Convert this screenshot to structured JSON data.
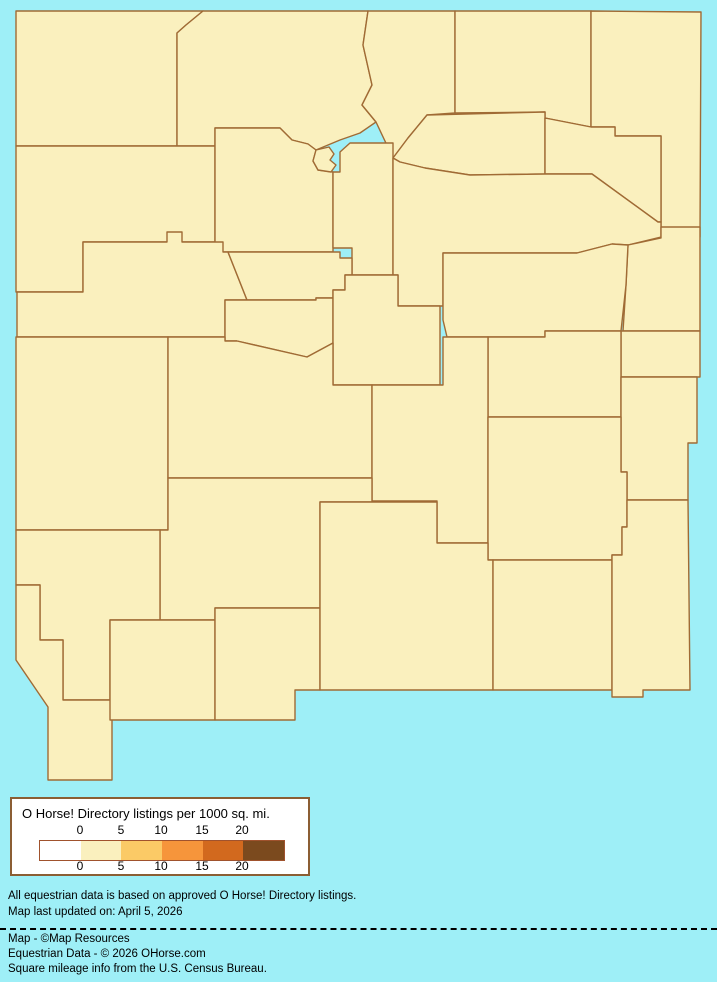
{
  "page": {
    "background_color": "#9EEFF7",
    "map_border_color": "#A06B35",
    "legend_border_color": "#8B5E34",
    "bar_border_color": "#A0522D"
  },
  "legend": {
    "title": "O Horse! Directory listings per 1000 sq. mi.",
    "ticks": [
      "0",
      "5",
      "10",
      "15",
      "20"
    ],
    "swatches": [
      {
        "bucket": "0",
        "color": "#FFFFFF"
      },
      {
        "bucket": "0–5",
        "color": "#FAF0BE"
      },
      {
        "bucket": "5–10",
        "color": "#FBCA66"
      },
      {
        "bucket": "10–15",
        "color": "#F6953B"
      },
      {
        "bucket": "15–20",
        "color": "#D2691E"
      },
      {
        "bucket": "20+",
        "color": "#7B4A1E"
      }
    ]
  },
  "footnotes": {
    "line1": "All equestrian data is based on approved O Horse! Directory listings.",
    "line2": "Map last updated on: April 5, 2026"
  },
  "credits": {
    "line1": "Map - ©Map Resources",
    "line2": "Equestrian Data - © 2026 OHorse.com",
    "line3": "Square mileage info from the U.S. Census Bureau."
  },
  "map": {
    "state": "New Mexico",
    "metric": "O Horse! Directory listings per 1000 sq. mi.",
    "counties": [
      {
        "id": "san_juan",
        "name": "San Juan",
        "bucket": "0–5",
        "fill": "#FAF0BE"
      },
      {
        "id": "rio_arriba",
        "name": "Rio Arriba",
        "bucket": "0–5",
        "fill": "#FAF0BE"
      },
      {
        "id": "taos",
        "name": "Taos",
        "bucket": "0–5",
        "fill": "#FAF0BE"
      },
      {
        "id": "colfax",
        "name": "Colfax",
        "bucket": "0–5",
        "fill": "#FAF0BE"
      },
      {
        "id": "union",
        "name": "Union",
        "bucket": "0–5",
        "fill": "#FAF0BE"
      },
      {
        "id": "mora",
        "name": "Mora",
        "bucket": "0",
        "fill": "#FEFEF8"
      },
      {
        "id": "harding",
        "name": "Harding",
        "bucket": "0",
        "fill": "#FEFEF8"
      },
      {
        "id": "mckinley",
        "name": "McKinley",
        "bucket": "0–5",
        "fill": "#FAF0BE"
      },
      {
        "id": "sandoval",
        "name": "Sandoval",
        "bucket": "0–5",
        "fill": "#FAF0BE"
      },
      {
        "id": "los_alamos",
        "name": "Los Alamos",
        "bucket": "5–10",
        "fill": "#FBCA66"
      },
      {
        "id": "santa_fe",
        "name": "Santa Fe",
        "bucket": "5–10",
        "fill": "#FBCA66"
      },
      {
        "id": "san_miguel",
        "name": "San Miguel",
        "bucket": "0–5",
        "fill": "#FAF0BE"
      },
      {
        "id": "quay",
        "name": "Quay",
        "bucket": "0–5",
        "fill": "#FAF0BE"
      },
      {
        "id": "cibola",
        "name": "Cibola",
        "bucket": "0",
        "fill": "#FEFEF8"
      },
      {
        "id": "bernalillo",
        "name": "Bernalillo",
        "bucket": "5–10",
        "fill": "#FBCA66"
      },
      {
        "id": "valencia",
        "name": "Valencia",
        "bucket": "0–5",
        "fill": "#FAF0BE"
      },
      {
        "id": "torrance",
        "name": "Torrance",
        "bucket": "0–5",
        "fill": "#FAF0BE"
      },
      {
        "id": "guadalupe",
        "name": "Guadalupe",
        "bucket": "0",
        "fill": "#FEFEF8"
      },
      {
        "id": "curry",
        "name": "Curry",
        "bucket": "0–5",
        "fill": "#FAF0BE"
      },
      {
        "id": "de_baca",
        "name": "De Baca",
        "bucket": "0",
        "fill": "#FEFEF8"
      },
      {
        "id": "roosevelt",
        "name": "Roosevelt",
        "bucket": "0",
        "fill": "#FEFEF8"
      },
      {
        "id": "catron",
        "name": "Catron",
        "bucket": "0–5",
        "fill": "#FAF0BE"
      },
      {
        "id": "socorro",
        "name": "Socorro",
        "bucket": "0–5",
        "fill": "#FAF0BE"
      },
      {
        "id": "lincoln",
        "name": "Lincoln",
        "bucket": "0–5",
        "fill": "#FAF0BE"
      },
      {
        "id": "chaves",
        "name": "Chaves",
        "bucket": "0–5",
        "fill": "#FAF0BE"
      },
      {
        "id": "sierra",
        "name": "Sierra",
        "bucket": "0–5",
        "fill": "#FAF0BE"
      },
      {
        "id": "grant",
        "name": "Grant",
        "bucket": "0–5",
        "fill": "#FAF0BE"
      },
      {
        "id": "hidalgo",
        "name": "Hidalgo",
        "bucket": "0",
        "fill": "#FEFEF8"
      },
      {
        "id": "luna",
        "name": "Luna",
        "bucket": "0",
        "fill": "#FEFEF8"
      },
      {
        "id": "dona_ana",
        "name": "Doña Ana",
        "bucket": "0–5",
        "fill": "#FAF0BE"
      },
      {
        "id": "otero",
        "name": "Otero",
        "bucket": "0–5",
        "fill": "#FAF0BE"
      },
      {
        "id": "eddy",
        "name": "Eddy",
        "bucket": "0–5",
        "fill": "#FAF0BE"
      },
      {
        "id": "lea",
        "name": "Lea",
        "bucket": "0",
        "fill": "#FEFEF8"
      }
    ]
  }
}
